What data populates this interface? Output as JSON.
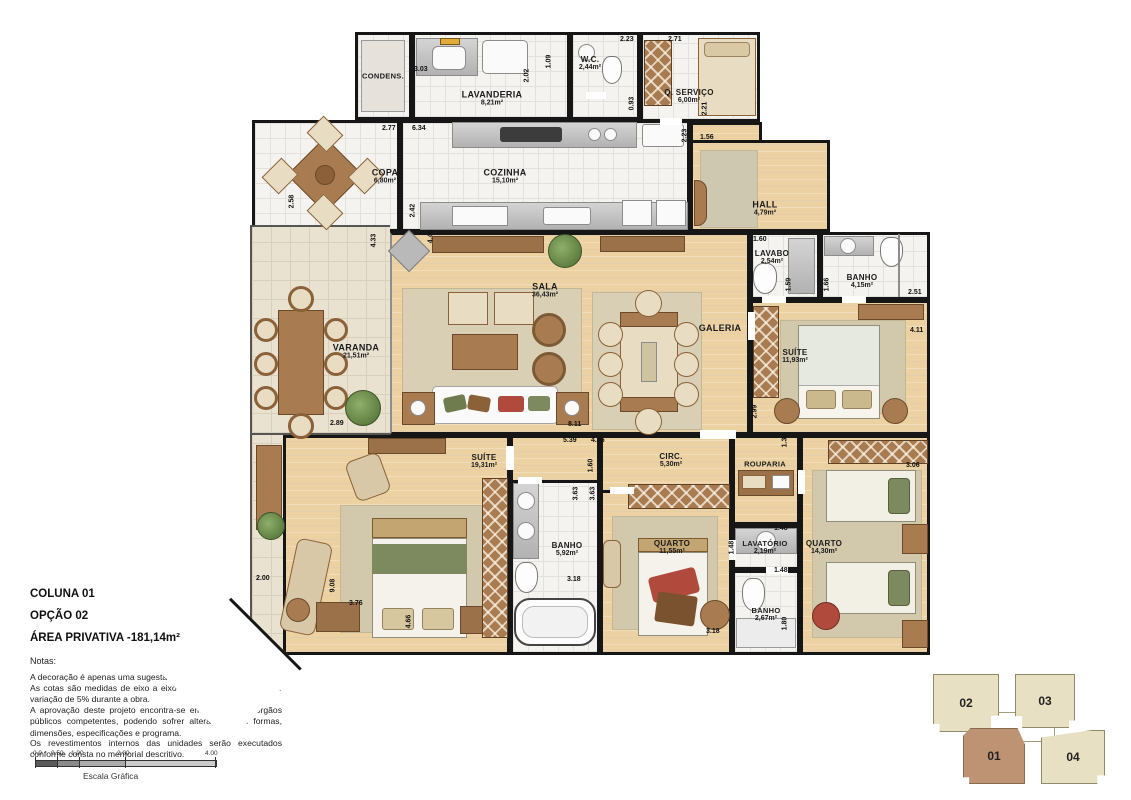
{
  "title": "Planta - Coluna 01 Opção 02",
  "plan": {
    "rooms": [
      {
        "name": "CONDENS."
      },
      {
        "name": "LAVANDERIA",
        "area": "8,21m²"
      },
      {
        "name": "W.C.",
        "area": "2,44m²"
      },
      {
        "name": "Q. SERVIÇO",
        "area": "6,00m²"
      },
      {
        "name": "COPA",
        "area": "6,80m²"
      },
      {
        "name": "COZINHA",
        "area": "15,10m²"
      },
      {
        "name": "HALL",
        "area": "4,79m²"
      },
      {
        "name": "LAVABO",
        "area": "2,54m²"
      },
      {
        "name": "BANHO",
        "area": "4,15m²"
      },
      {
        "name": "SALA",
        "area": "36,43m²"
      },
      {
        "name": "GALERIA"
      },
      {
        "name": "SUÍTE",
        "area": "11,93m²"
      },
      {
        "name": "VARANDA",
        "area": "21,51m²"
      },
      {
        "name": "SUÍTE",
        "area": "19,31m²"
      },
      {
        "name": "CIRC.",
        "area": "5,30m²"
      },
      {
        "name": "ROUPARIA"
      },
      {
        "name": "BANHO",
        "area": "5,92m²"
      },
      {
        "name": "QUARTO",
        "area": "11,55m²"
      },
      {
        "name": "LAVATÓRIO",
        "area": "2,19m²"
      },
      {
        "name": "QUARTO",
        "area": "14,30m²"
      },
      {
        "name": "BANHO",
        "area": "2,67m²"
      }
    ],
    "dims": [
      "3.03",
      "2.02",
      "1.09",
      "2.23",
      "2.71",
      "0.93",
      "2.21",
      "2.77",
      "6.34",
      "1.56",
      "2.23",
      "2.58",
      "2.42",
      "4.33",
      "4.40",
      "1.60",
      "1.59",
      "1.66",
      "2.51",
      "4.11",
      "2.99",
      "1.38",
      "8.11",
      "2.89",
      "5.39",
      "4.66",
      "1.60",
      "3.63",
      "3.63",
      "3.06",
      "1.48",
      "1.48",
      "1.48",
      "2.00",
      "9.08",
      "3.76",
      "3.18",
      "4.66",
      "3.18",
      "1.80",
      "4.66"
    ]
  },
  "info": {
    "coluna": "COLUNA 01",
    "opcao": "OPÇÃO 02",
    "area_privativa": "ÁREA PRIVATIVA -181,14m²",
    "notes_title": "Notas:",
    "notes": [
      "A decoração é apenas uma sugestão.",
      "As cotas são medidas de eixo a eixo de parede podendo sofrer variação de 5% durante a obra.",
      "A aprovação deste projeto encontra-se em análise nos órgãos públicos competentes, podendo sofrer alterações nas formas, dimensões, especificações e programa.",
      "Os revestimentos internos das unidades serão executados conforme consta no memorial descritivo."
    ]
  },
  "scalebar": {
    "ticks": [
      "0.0",
      "0.50",
      "1.00",
      "2.00",
      "4.00"
    ],
    "caption": "Escala Gráfica"
  },
  "keyplan": {
    "units": [
      {
        "label": "02",
        "highlighted": false
      },
      {
        "label": "03",
        "highlighted": false
      },
      {
        "label": "01",
        "highlighted": true
      },
      {
        "label": "04",
        "highlighted": false
      }
    ]
  },
  "colors": {
    "wall": "#161616",
    "wood_floor": "#ecd2a2",
    "tile_floor": "#f4f3f0",
    "varanda_floor": "#eae2d1",
    "furniture_brown": "#a87c50",
    "rug": "#d8cfb4",
    "accent_red": "#b04a3c",
    "accent_green": "#7d8a5f",
    "keyplan_beige": "#e7e0c3",
    "keyplan_highlight": "#bd9373"
  }
}
